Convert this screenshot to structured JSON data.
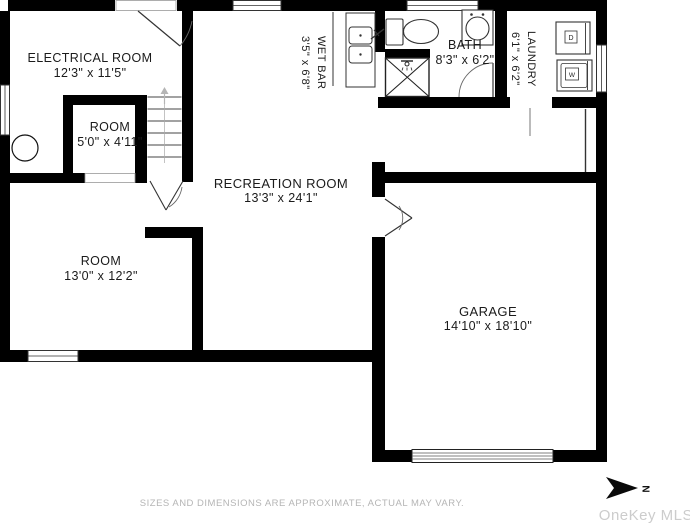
{
  "rooms": [
    {
      "name": "ELECTRICAL ROOM",
      "dims": "12'3\" x 11'5\""
    },
    {
      "name": "ROOM",
      "dims": "5'0\" x 4'11\""
    },
    {
      "name": "WET BAR",
      "dims": "3'5\" x 6'8\""
    },
    {
      "name": "BATH",
      "dims": "8'3\" x 6'2\""
    },
    {
      "name": "LAUNDRY",
      "dims": "6'1\" x 6'2\""
    },
    {
      "name": "RECREATION ROOM",
      "dims": "13'3\" x 24'1\""
    },
    {
      "name": "ROOM",
      "dims": "13'0\" x 12'2\""
    },
    {
      "name": "GARAGE",
      "dims": "14'10\" x 18'10\""
    }
  ],
  "appliances": {
    "washer_label": "W",
    "dryer_label": "D"
  },
  "compass": {
    "north_label": "N"
  },
  "footer": {
    "disclaimer": "SIZES AND DIMENSIONS ARE APPROXIMATE, ACTUAL MAY VARY."
  },
  "watermark": {
    "text": "OneKey MLS"
  },
  "colors": {
    "wall": "#000000",
    "label_text": "#1b1b1b",
    "muted_text": "#b5b5b5",
    "watermark_text": "#cccccc"
  }
}
